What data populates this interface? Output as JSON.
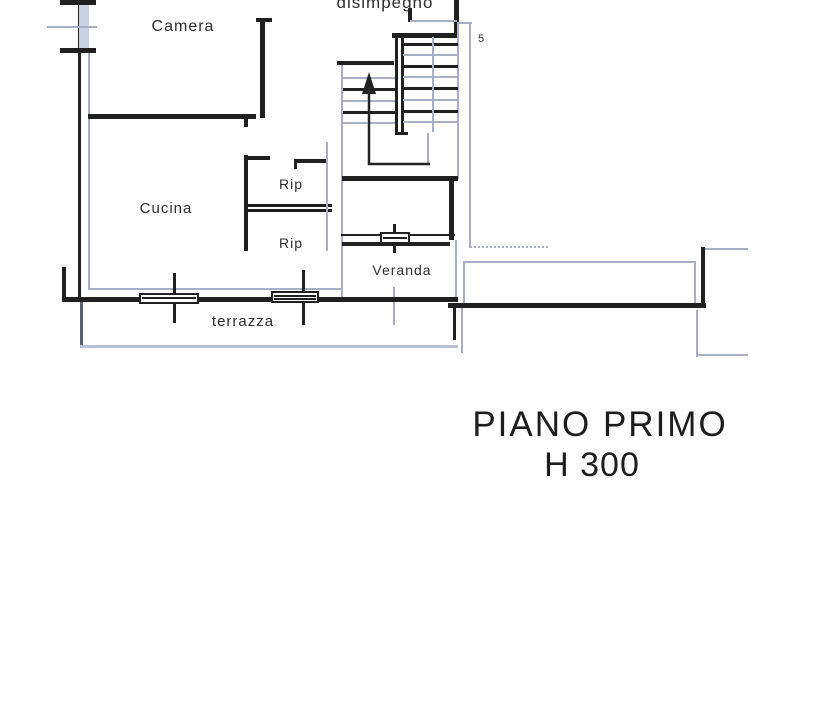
{
  "plan": {
    "rooms": {
      "disimpegno": "disimpegno",
      "camera": "Camera",
      "cucina": "Cucina",
      "rip_upper": "Rip",
      "rip_lower": "Rip",
      "veranda": "Veranda",
      "terrazza": "terrazza"
    },
    "annotations": {
      "stair_mark": "5"
    },
    "caption": {
      "line1": "PIANO PRIMO",
      "line2": "H 300"
    }
  },
  "colors": {
    "ink": "#202020",
    "faint": "#a8afc4",
    "paper": "#ffffff",
    "window_glass": "#c9d3e3"
  }
}
